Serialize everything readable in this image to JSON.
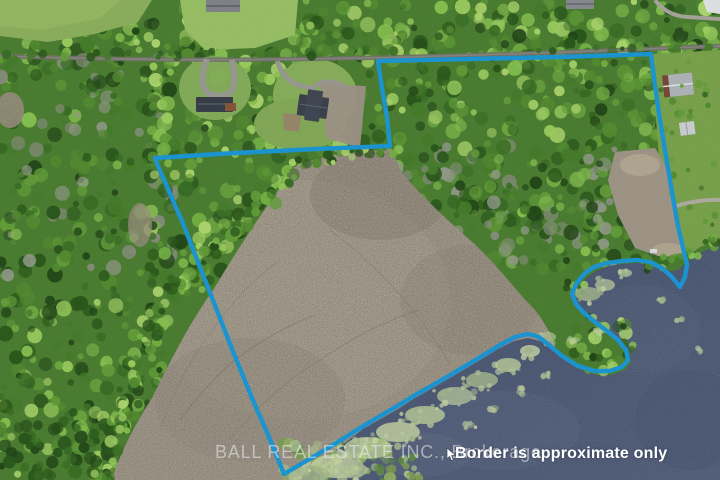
{
  "scene": {
    "type": "aerial-drone-photo",
    "description": "Aerial view of wooded lakefront acreage with marked property line, road and houses at top, marsh and lake below",
    "watermark_text": "BALL REAL ESTATE INC., Brokerage",
    "disclaimer_text": "Border is approximate only"
  },
  "colors": {
    "boundary": "#1d9ad8",
    "water_deep": "#5b6884",
    "water_shallow": "#505d79",
    "marsh": "#a59c8c",
    "forest": "#4d8133",
    "algae": "#c6d7a0",
    "field": "#8fb35f",
    "road": "#75756d"
  },
  "boundary": {
    "stroke_width": 4.4,
    "points": [
      [
        378,
        61
      ],
      [
        470,
        59
      ],
      [
        560,
        57
      ],
      [
        651,
        54
      ],
      [
        655,
        86
      ],
      [
        660,
        120
      ],
      [
        666,
        156
      ],
      [
        672,
        192
      ],
      [
        678,
        226
      ],
      [
        684,
        252
      ],
      [
        687,
        265
      ],
      [
        685,
        277
      ],
      [
        680,
        287
      ],
      [
        672,
        277
      ],
      [
        662,
        268
      ],
      [
        650,
        262
      ],
      [
        637,
        260
      ],
      [
        622,
        261
      ],
      [
        607,
        263
      ],
      [
        594,
        267
      ],
      [
        584,
        274
      ],
      [
        576,
        284
      ],
      [
        572,
        294
      ],
      [
        576,
        304
      ],
      [
        584,
        313
      ],
      [
        595,
        322
      ],
      [
        607,
        331
      ],
      [
        618,
        340
      ],
      [
        626,
        350
      ],
      [
        628,
        360
      ],
      [
        622,
        367
      ],
      [
        610,
        371
      ],
      [
        595,
        371
      ],
      [
        578,
        366
      ],
      [
        562,
        356
      ],
      [
        549,
        345
      ],
      [
        539,
        337
      ],
      [
        528,
        334
      ],
      [
        515,
        337
      ],
      [
        500,
        345
      ],
      [
        482,
        356
      ],
      [
        462,
        368
      ],
      [
        440,
        381
      ],
      [
        417,
        394
      ],
      [
        399,
        405
      ],
      [
        365,
        425
      ],
      [
        325,
        450
      ],
      [
        284,
        474
      ],
      [
        269,
        437
      ],
      [
        252,
        398
      ],
      [
        234,
        354
      ],
      [
        216,
        308
      ],
      [
        198,
        262
      ],
      [
        182,
        221
      ],
      [
        168,
        189
      ],
      [
        158,
        166
      ],
      [
        155,
        158
      ],
      [
        235,
        153
      ],
      [
        315,
        149
      ],
      [
        390,
        146
      ],
      [
        387,
        117
      ],
      [
        382,
        88
      ]
    ]
  }
}
